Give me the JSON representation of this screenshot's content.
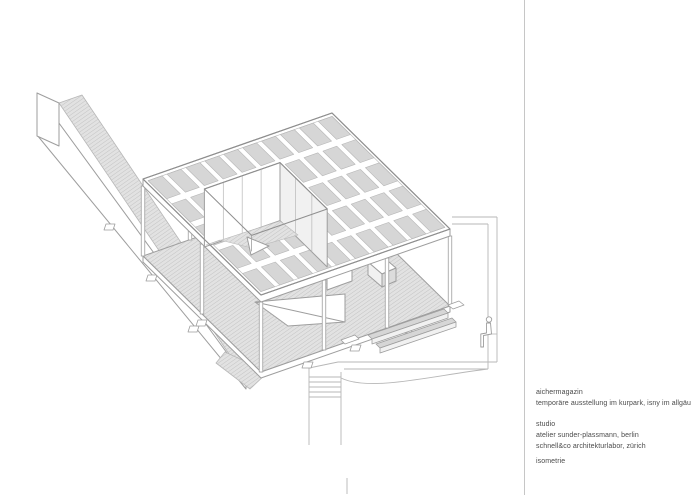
{
  "sheet": {
    "background": "#ffffff",
    "divider_color": "#c6c6c6"
  },
  "titleblock": {
    "text_color": "#4a4a4a",
    "project": {
      "name": "aichermagazin",
      "description": "temporäre ausstellung im kurpark, isny im allgäu"
    },
    "studio": {
      "label": "studio",
      "offices": [
        "atelier sunder-plassmann, berlin",
        "schnell&co architekturlabor, zürich"
      ]
    },
    "drawing": {
      "view_label": "isometrie"
    }
  },
  "drawing": {
    "type": "axonometric architectural line drawing",
    "subject": "exhibition pavilion with slatted roof grid, roof opening, columns, hatched floor deck, long access ramp, site boundary with stairs and sitting figure",
    "colors": {
      "line": "#9e9e9e",
      "line_dark": "#8f8f8f",
      "line_light": "#b7b7b7",
      "panel": "#d6d6d6",
      "hatch_bg": "#e2e2e2",
      "hatch_line": "#c3c3c3",
      "face_shade": "#f1f1f1",
      "white": "#ffffff"
    }
  }
}
